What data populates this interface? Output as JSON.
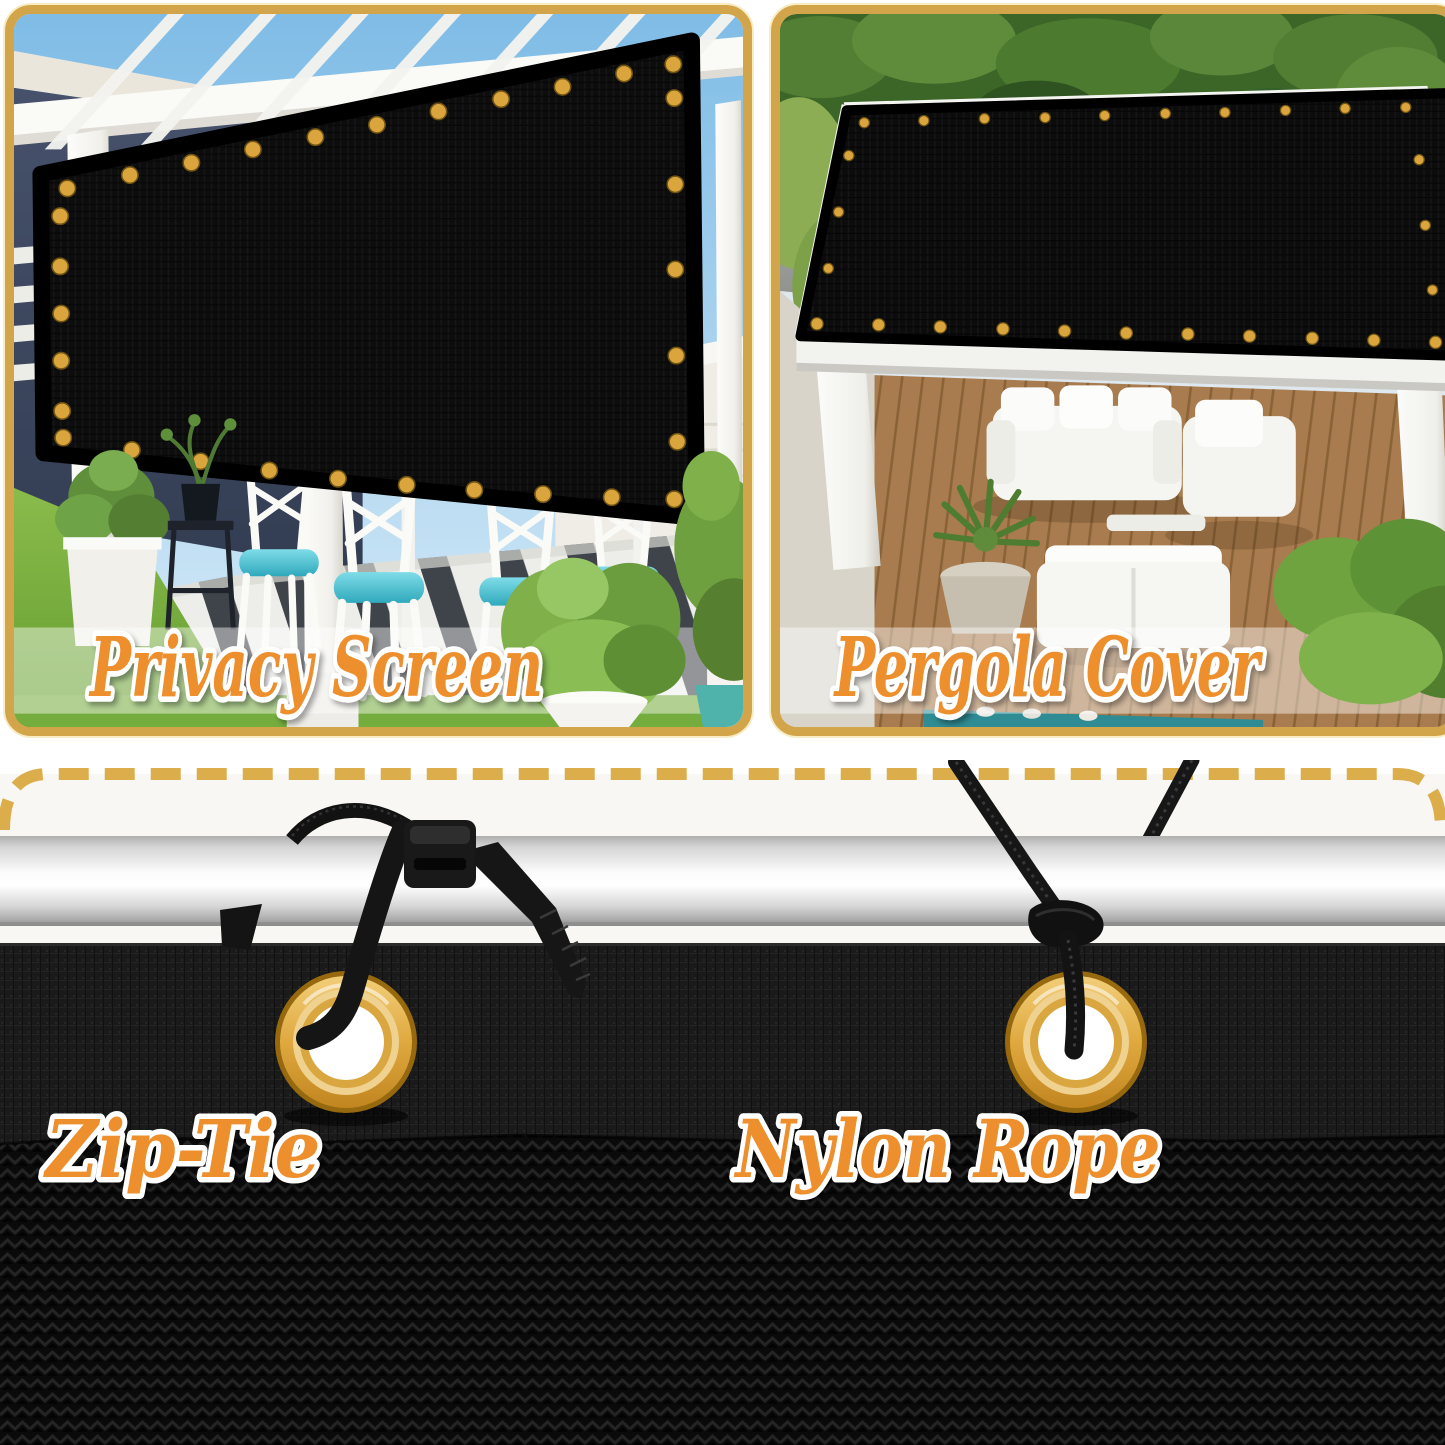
{
  "captions": {
    "privacy_screen": "Privacy Screen",
    "pergola_cover": "Pergola Cover",
    "zip_tie": "Zip-Tie",
    "nylon_rope": "Nylon Rope"
  },
  "colors": {
    "panel_border_gold": "#D2A54B",
    "dash_gold": "#DCAE4B",
    "caption_orange": "#EE8F2E",
    "caption_outline": "#FFFFFF",
    "grommet_gold": "#D9A53C",
    "mesh_black": "#161616",
    "pole_silver": "#E8E8E8",
    "background_white": "#FFFFFF"
  }
}
